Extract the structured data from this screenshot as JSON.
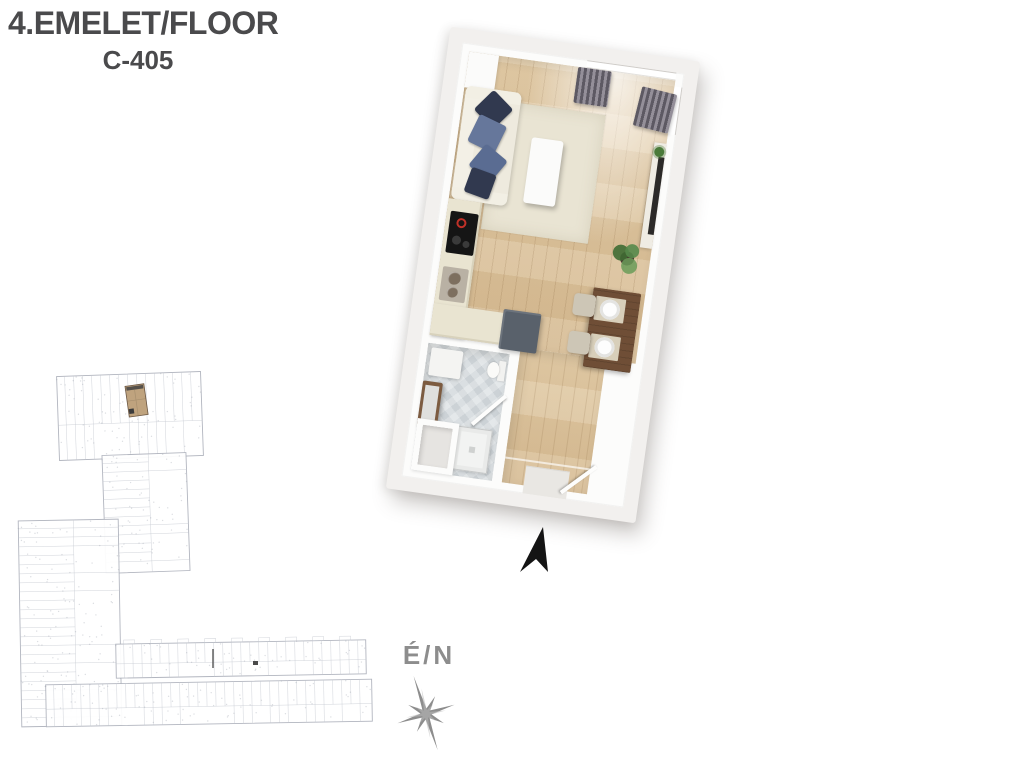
{
  "header": {
    "title": "4.EMELET/FLOOR",
    "unit_code": "C-405"
  },
  "compass": {
    "label": "É/N"
  },
  "icons": {
    "north_arrow": "solid black stylized up arrow",
    "compass_rose": "gray eight-point star rose"
  },
  "colors": {
    "title_text": "#4a4a4c",
    "compass_gray": "#8d8d8d",
    "north_arrow": "#141414",
    "slab": "#f2f0ee",
    "walls": "#fcfcfb",
    "rug": "#e9e4d3",
    "sofa": "#eeeade",
    "pillow_navy": "#31394f",
    "pillow_blue": "#66779b",
    "kitchen_counter": "#e9e4d1",
    "appliance_gray": "#59616b",
    "table_wood": "#6f4e36",
    "vanity_wood": "#7c5b40",
    "plant_green": "#4a7a3a",
    "siteplan_line": "#aeb2bc",
    "siteplan_inner_line": "#c5c9d1",
    "unit_highlight": "#bfa37e",
    "unit_highlight_dark": "#6b5744"
  },
  "site_plan": {
    "highlighted_unit_code": "C-405"
  }
}
